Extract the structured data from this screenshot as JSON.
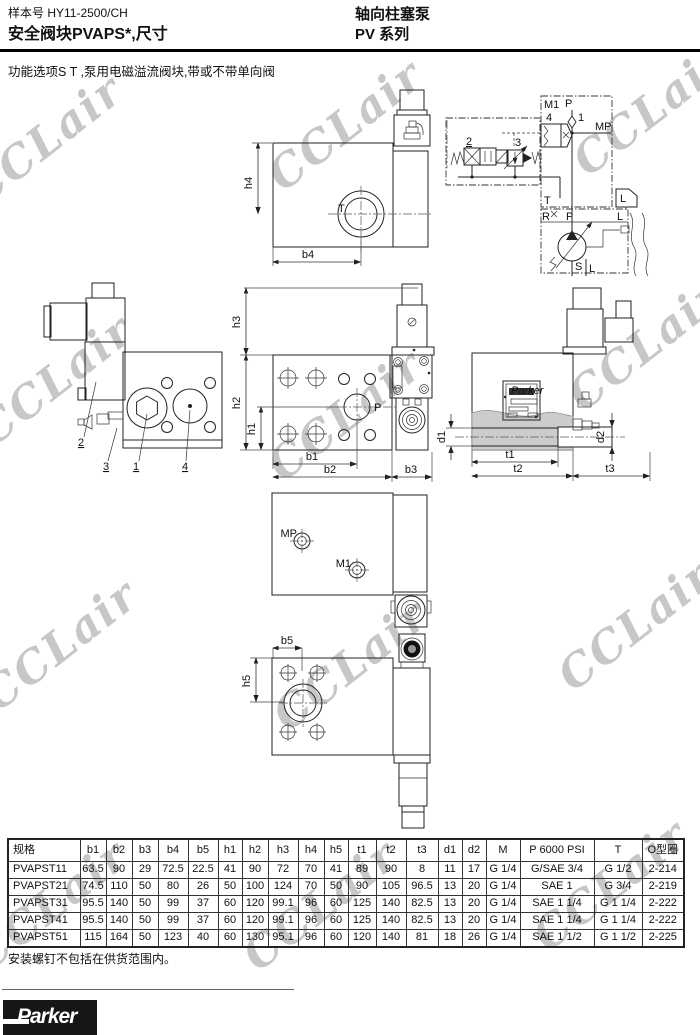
{
  "header": {
    "doc_number": "样本号 HY11-2500/CH",
    "title": "安全阀块PVAPS*,尺寸",
    "product": "轴向柱塞泵",
    "series": "PV 系列"
  },
  "subtitle": "功能选项S  T ,泵用电磁溢流阀块,带或不带单向阀",
  "watermark": {
    "text": "CCLair",
    "color": "#c7c7c7"
  },
  "labels": {
    "T": "T",
    "P": "P",
    "MP": "MP",
    "M1": "M1",
    "h1": "h1",
    "h2": "h2",
    "h3": "h3",
    "h4": "h4",
    "h5": "h5",
    "b1": "b1",
    "b2": "b2",
    "b3": "b3",
    "b4": "b4",
    "b5": "b5",
    "t1": "t1",
    "t2": "t2",
    "t3": "t3",
    "d1": "d1",
    "d2": "d2",
    "n1": "1",
    "n2": "2",
    "n3": "3",
    "n4": "4",
    "R": "R",
    "S": "S",
    "L": "L",
    "plate": "Parker"
  },
  "table": {
    "headers": [
      "规格",
      "b1",
      "b2",
      "b3",
      "b4",
      "b5",
      "h1",
      "h2",
      "h3",
      "h4",
      "h5",
      "t1",
      "t2",
      "t3",
      "d1",
      "d2",
      "M",
      "P 6000 PSI",
      "T",
      "O型圈"
    ],
    "rows": [
      [
        "PVAPST11",
        "63.5",
        "90",
        "29",
        "72.5",
        "22.5",
        "41",
        "90",
        "72",
        "70",
        "41",
        "89",
        "90",
        "8",
        "11",
        "17",
        "G 1/4",
        "G/SAE 3/4",
        "G 1/2",
        "2-214"
      ],
      [
        "PVAPST21",
        "74.5",
        "110",
        "50",
        "80",
        "26",
        "50",
        "100",
        "124",
        "70",
        "50",
        "90",
        "105",
        "96.5",
        "13",
        "20",
        "G 1/4",
        "SAE 1",
        "G 3/4",
        "2-219"
      ],
      [
        "PVAPST31",
        "95.5",
        "140",
        "50",
        "99",
        "37",
        "60",
        "120",
        "99.1",
        "96",
        "60",
        "125",
        "140",
        "82.5",
        "13",
        "20",
        "G 1/4",
        "SAE 1 1/4",
        "G 1 1/4",
        "2-222"
      ],
      [
        "PVAPST41",
        "95.5",
        "140",
        "50",
        "99",
        "37",
        "60",
        "120",
        "99.1",
        "96",
        "60",
        "125",
        "140",
        "82.5",
        "13",
        "20",
        "G 1/4",
        "SAE 1 1/4",
        "G 1 1/4",
        "2-222"
      ],
      [
        "PVAPST51",
        "115",
        "164",
        "50",
        "123",
        "40",
        "60",
        "130",
        "95.1",
        "96",
        "60",
        "120",
        "140",
        "81",
        "18",
        "26",
        "G 1/4",
        "SAE 1 1/2",
        "G 1 1/2",
        "2-225"
      ]
    ]
  },
  "footnote": "安装螺钉不包括在供货范围内。",
  "logo_text": "Parker"
}
